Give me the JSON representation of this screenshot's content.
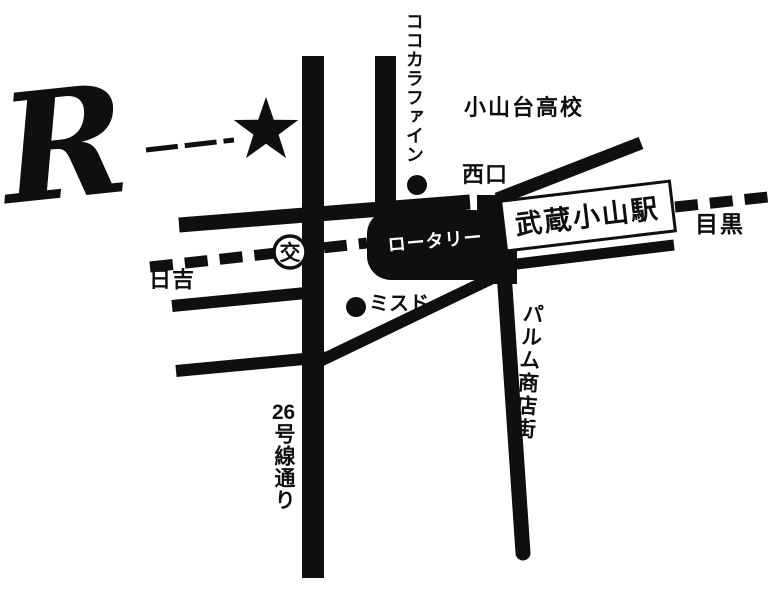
{
  "map": {
    "logo": {
      "letter": "R"
    },
    "station": {
      "name": "武蔵小山駅"
    },
    "rotary": {
      "label": "ロータリー"
    },
    "police_box": {
      "label": "交"
    },
    "directions": {
      "west": "日吉",
      "east": "目黒"
    },
    "landmarks": {
      "pharmacy": "ココカラファイン",
      "high_school": "小山台高校",
      "west_exit": "西口",
      "donut_shop": "ミスド"
    },
    "streets": {
      "shopping_arcade": "パルム商店街",
      "route26_number": "26",
      "route26_name": "号線通り"
    },
    "colors": {
      "ink": "#0f0f0f",
      "background": "#ffffff"
    }
  }
}
